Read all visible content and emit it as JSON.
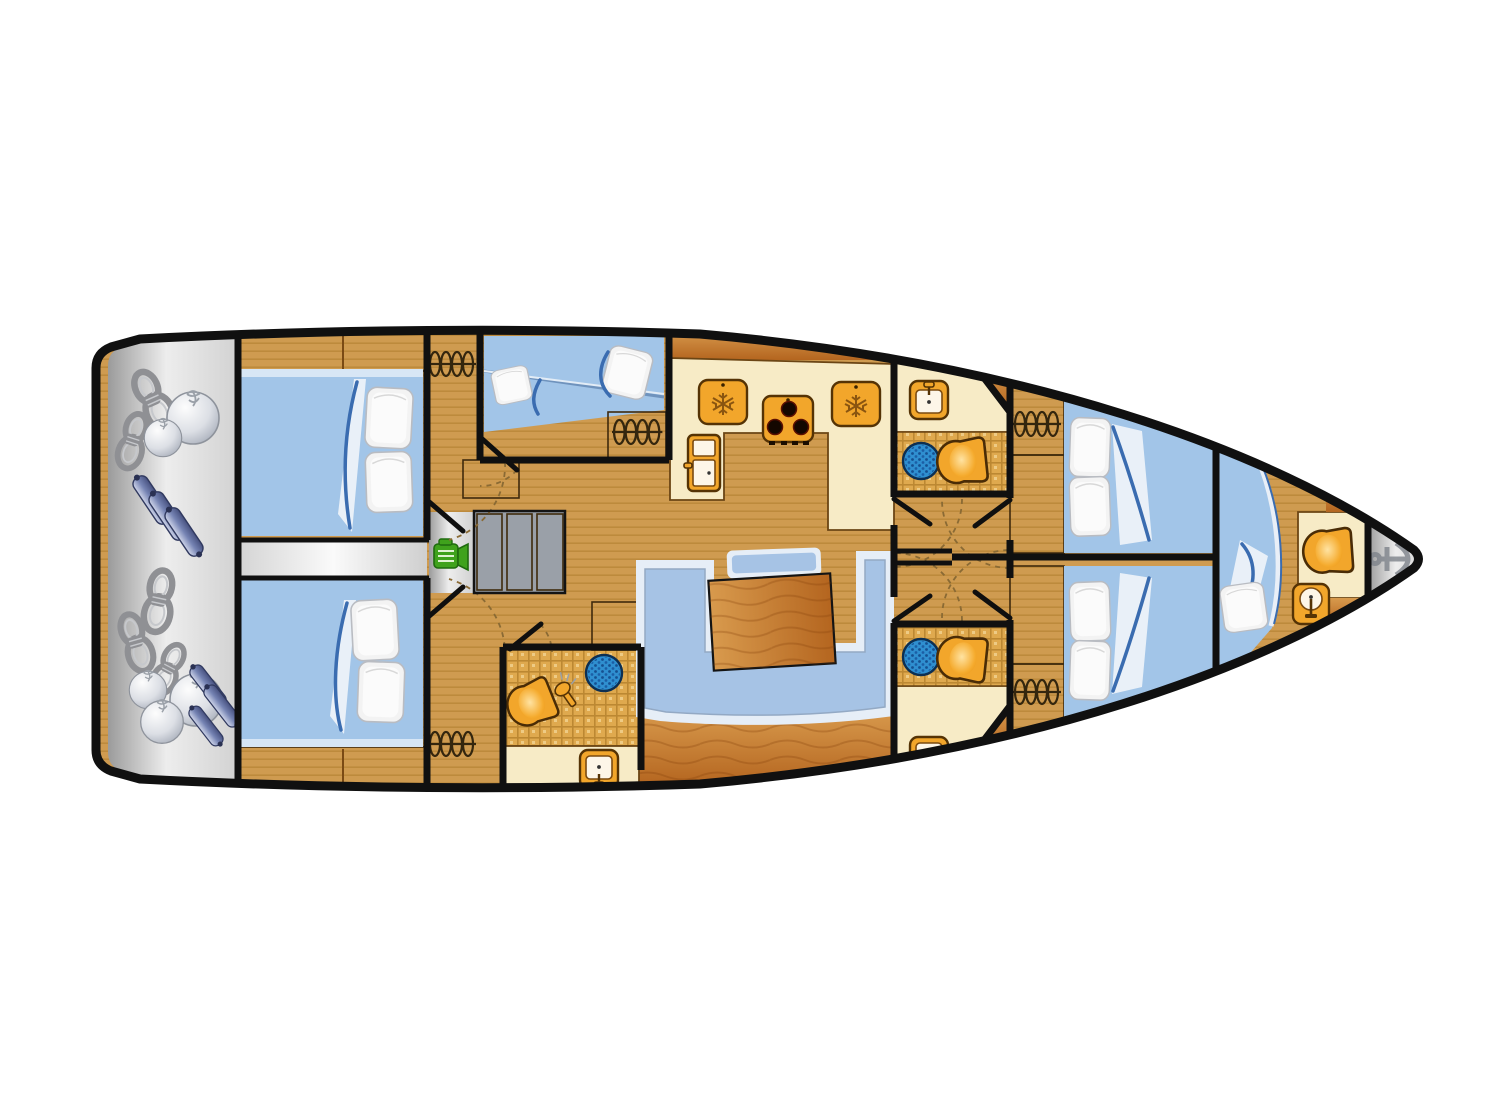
{
  "meta": {
    "type": "yacht-floor-plan",
    "subject": "Sailing yacht interior layout, top-down deck plan",
    "bow_direction": "right",
    "stern_direction": "left",
    "visible_text": "none"
  },
  "colors": {
    "wall": "#101010",
    "floor": "#cf9b50",
    "floor_stripe": "#bd8a3c",
    "wood_light": "#d89a4d",
    "wood_dark": "#bc6c24",
    "cream": "#f7ebc6",
    "tile": "#dfa94e",
    "tile_grid": "#bc8832",
    "bed": "#a2c5e8",
    "bed_hi": "#d7e6f5",
    "pillow": "#f3f3f3",
    "blanket": "#3a6cb0",
    "sofa": "#a6c3e5",
    "sofa_trim": "#e6eef7",
    "table": "#d2803a",
    "icon_orange": "#f2a62b",
    "icon_outline": "#553305",
    "shower": "#2f8fd0",
    "shower_dot": "#1b5fa6",
    "engine_green": "#3fa21c",
    "anchor_gray": "#8d929a",
    "rope_gray": "#8f9094",
    "fender_ball": "#c7ccd6",
    "fender_cyl": "#6a76a8",
    "arc": "#8a6a34"
  },
  "rooms": [
    {
      "id": "stern-locker",
      "name": "Stern locker with mooring ropes and fenders",
      "fixtures": [
        "rope-coils",
        "ball-fenders",
        "cylinder-fenders"
      ]
    },
    {
      "id": "aft-cabin-port",
      "name": "Aft double cabin port",
      "fixtures": [
        "double-berth",
        "two-pillows",
        "blanket"
      ]
    },
    {
      "id": "aft-cabin-starboard",
      "name": "Aft double cabin starboard",
      "fixtures": [
        "double-berth",
        "two-pillows",
        "blanket"
      ]
    },
    {
      "id": "companionway",
      "name": "Companionway steps over engine compartment",
      "fixtures": [
        "three-steps",
        "engine"
      ]
    },
    {
      "id": "bunk-cabin-mid-port",
      "name": "Mid port bunk cabin",
      "fixtures": [
        "two-single-berths",
        "two-pillows",
        "hanging-locker"
      ]
    },
    {
      "id": "aft-head-starboard",
      "name": "Aft bathroom starboard",
      "fixtures": [
        "toilet",
        "shower",
        "shower-handle",
        "sink"
      ]
    },
    {
      "id": "galley",
      "name": "Galley",
      "fixtures": [
        "refrigerator",
        "freezer-top-load",
        "freezer-top-load",
        "stove-3-burner"
      ]
    },
    {
      "id": "salon",
      "name": "Salon with U-shaped sofa and table",
      "fixtures": [
        "u-sofa",
        "table",
        "back-cushion"
      ]
    },
    {
      "id": "corridor-forward",
      "name": "Forward corridor",
      "fixtures": [
        "doors"
      ]
    },
    {
      "id": "forward-head-port",
      "name": "Forward bathroom port",
      "fixtures": [
        "sink",
        "shower",
        "toilet"
      ]
    },
    {
      "id": "forward-head-starboard",
      "name": "Forward bathroom starboard",
      "fixtures": [
        "sink",
        "shower",
        "toilet"
      ]
    },
    {
      "id": "forward-cabin-port",
      "name": "Forward double cabin port",
      "fixtures": [
        "double-berth",
        "two-pillows",
        "hanging-locker",
        "dresser"
      ]
    },
    {
      "id": "forward-cabin-starboard",
      "name": "Forward double cabin starboard",
      "fixtures": [
        "double-berth",
        "two-pillows",
        "hanging-locker",
        "dresser"
      ]
    },
    {
      "id": "bow-cabin",
      "name": "Bow V-berth cabin",
      "fixtures": [
        "v-berth",
        "pillow",
        "blanket"
      ]
    },
    {
      "id": "bow-head",
      "name": "Bow bathroom",
      "fixtures": [
        "toilet",
        "sink"
      ]
    },
    {
      "id": "anchor-locker",
      "name": "Anchor locker at bow tip",
      "fixtures": [
        "anchor"
      ]
    }
  ],
  "fixture_counts": {
    "toilets": 4,
    "sinks": 4,
    "showers": 3,
    "berths": 7,
    "hanging_lockers": 5,
    "freezers": 2,
    "stoves": 1,
    "refrigerators": 1,
    "engines": 1,
    "anchors": 1
  }
}
